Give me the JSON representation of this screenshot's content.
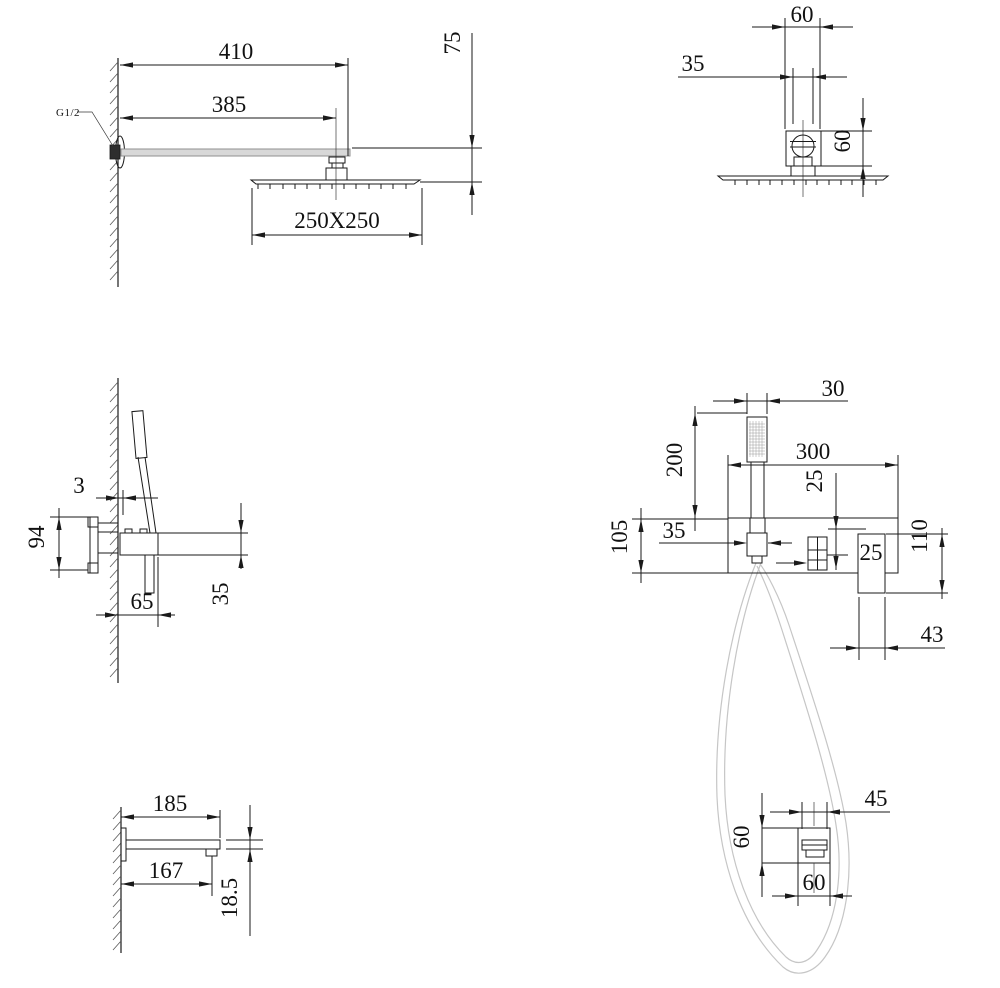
{
  "title": "shower-system-installation-dimension-drawing",
  "colors": {
    "line": "#1a1a1a",
    "metal_gray": "#d8d8d8",
    "hose_gray": "#c6c6c6",
    "background": "#ffffff"
  },
  "views": {
    "head_side": {
      "name": "rain-shower-head-side-view",
      "thread_label": "G1/2",
      "dim_410": "410",
      "dim_385": "385",
      "dim_75": "75",
      "dim_250x250": "250X250"
    },
    "head_front": {
      "name": "rain-shower-head-front-view",
      "dim_60_width": "60",
      "dim_35_width": "35",
      "dim_60_height": "60"
    },
    "valve_side": {
      "name": "mixer-valve-side-view",
      "dim_3": "3",
      "dim_94": "94",
      "dim_65": "65",
      "dim_35": "35"
    },
    "valve_front": {
      "name": "mixer-valve-front-view",
      "dim_30": "30",
      "dim_300": "300",
      "dim_200": "200",
      "dim_25_offset": "25",
      "dim_35": "35",
      "dim_105": "105",
      "dim_25_handle": "25",
      "dim_110": "110",
      "dim_43": "43"
    },
    "spout_side": {
      "name": "tub-spout-side-view",
      "dim_185": "185",
      "dim_167": "167",
      "dim_18_5": "18.5"
    },
    "holder_front": {
      "name": "handshower-holder-front-view",
      "dim_45": "45",
      "dim_60_height": "60",
      "dim_60_width": "60"
    }
  }
}
